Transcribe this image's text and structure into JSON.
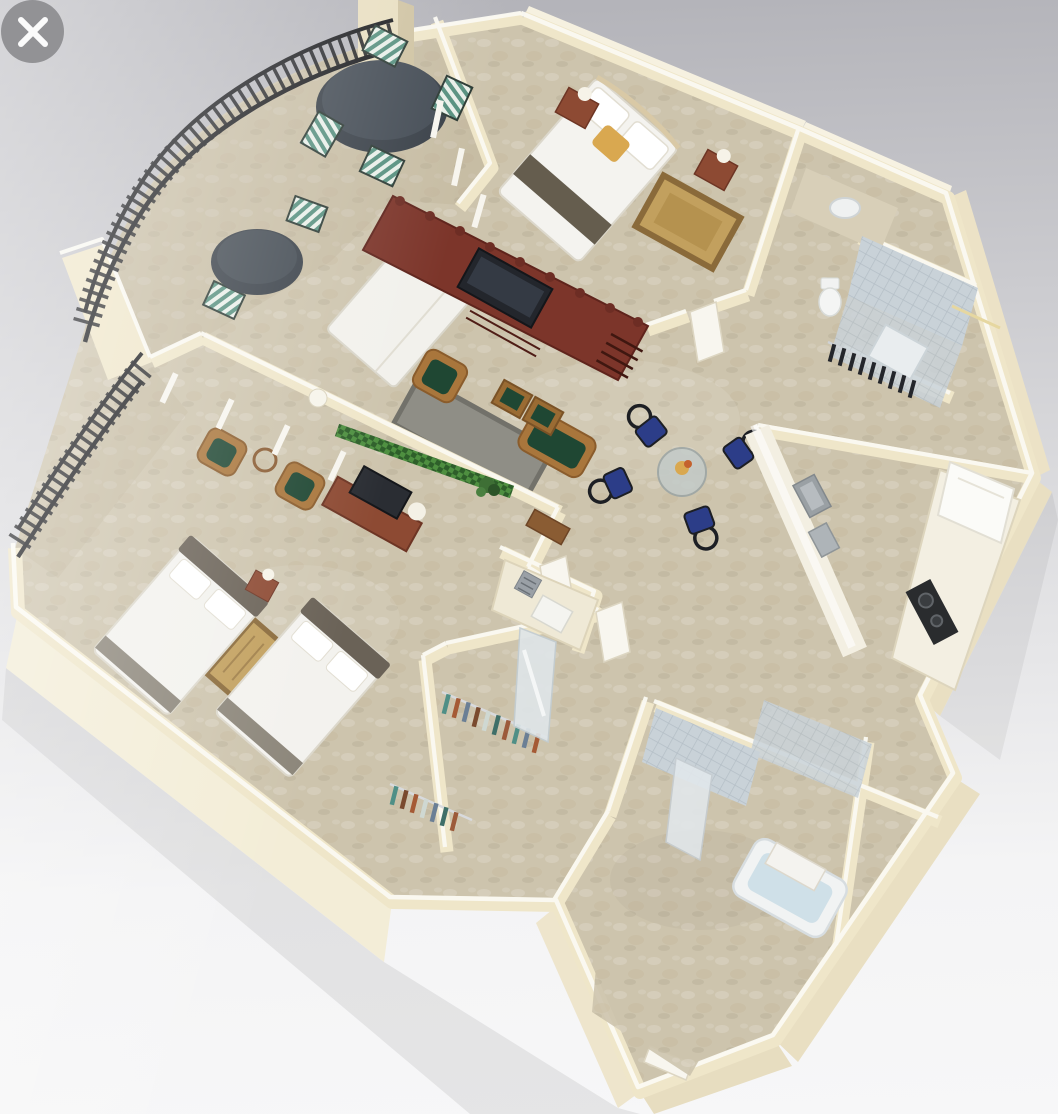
{
  "viewer": {
    "close_button": {
      "icon": "close-icon",
      "shape": "gray-circle-white-x"
    }
  },
  "scene": {
    "type": "3d-floorplan-render",
    "description": "Isometric 3D rendering of a two-bedroom apartment floor plan with a curved wrap-around balcony, cream walls and travertine floors",
    "rooms": [
      {
        "name": "balcony",
        "furniture": [
          "round-patio-table",
          "striped-patio-chairs",
          "bistro-table",
          "iron-railing",
          "column"
        ]
      },
      {
        "name": "master-bedroom",
        "furniture": [
          "king-bed",
          "gold-accent-pillow",
          "nightstands",
          "area-rug"
        ]
      },
      {
        "name": "master-bathroom",
        "furniture": [
          "tiled-shower",
          "vanity-sink",
          "toilet",
          "linen-closet"
        ]
      },
      {
        "name": "living-room",
        "furniture": [
          "murphy-bed",
          "entertainment-wall-unit",
          "tv",
          "wicker-armchair",
          "wicker-loveseat",
          "coffee-tables",
          "gray-rug",
          "planter-strip",
          "table-lamps"
        ]
      },
      {
        "name": "dining-area",
        "furniture": [
          "glass-dining-table",
          "blue-dining-chairs",
          "centerpiece"
        ]
      },
      {
        "name": "kitchen",
        "furniture": [
          "counter-peninsula",
          "refrigerator",
          "cooktop",
          "sink"
        ]
      },
      {
        "name": "second-bedroom",
        "furniture": [
          "queen-bed",
          "queen-bed",
          "dresser-with-tv",
          "wicker-chairs",
          "accent-rug",
          "balcony-doors"
        ]
      },
      {
        "name": "walk-in-closet",
        "furniture": [
          "hanging-clothes",
          "mirrored-door"
        ]
      },
      {
        "name": "second-bathroom",
        "furniture": [
          "bathtub",
          "tiled-walls",
          "shower-panels",
          "vanity"
        ]
      },
      {
        "name": "entry",
        "furniture": [
          "entry-door"
        ]
      }
    ]
  },
  "palette": {
    "bg_top": "#b2b2b8",
    "bg_mid": "#d8d8db",
    "bg_low": "#f4f4f5",
    "wall": "#efe6c9",
    "wall_top": "#fbfaf3",
    "wall_face": "#f3edd7",
    "floor": "#cdc4ad",
    "balcony_tint": "#b9ad92",
    "wood_dark": "#7c352a",
    "wood_mid": "#8d4a33",
    "wicker": "#a9763c",
    "cushion_green": "#1f4733",
    "stripe_teal": "#57907f",
    "navy": "#2c3d88",
    "railing": "#1b1c1f",
    "rug_tan": "#c2a05e",
    "rug_gray": "#8f8e86",
    "tile": "#c9d2d8",
    "tub_water": "#cfe0e8",
    "accent_gold": "#d9a850",
    "close_btn": "#8d8d90"
  }
}
